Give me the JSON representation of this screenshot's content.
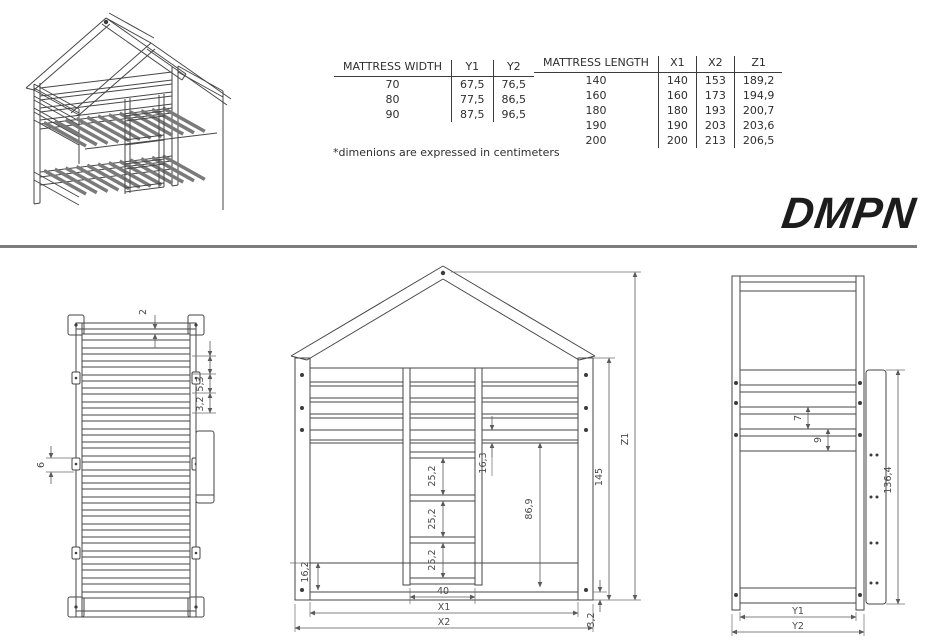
{
  "brand": {
    "logo_text": "DMPN"
  },
  "note": "*dimenions are expressed in centimeters",
  "tables": {
    "width": {
      "headers": [
        "MATTRESS WIDTH",
        "Y1",
        "Y2"
      ],
      "rows": [
        [
          "70",
          "67,5",
          "76,5"
        ],
        [
          "80",
          "77,5",
          "86,5"
        ],
        [
          "90",
          "87,5",
          "96,5"
        ]
      ]
    },
    "length": {
      "headers": [
        "MATTRESS LENGTH",
        "X1",
        "X2",
        "Z1"
      ],
      "rows": [
        [
          "140",
          "140",
          "153",
          "189,2"
        ],
        [
          "160",
          "160",
          "173",
          "194,9"
        ],
        [
          "180",
          "180",
          "193",
          "200,7"
        ],
        [
          "190",
          "190",
          "203",
          "203,6"
        ],
        [
          "200",
          "200",
          "213",
          "206,5"
        ]
      ]
    }
  },
  "views": {
    "top": {
      "dims": {
        "top_gap": "2",
        "slat_pitch": "5,3",
        "slat_width": "3,2",
        "bracket_height": "6"
      }
    },
    "front": {
      "dims": {
        "rail_gap": "16,3",
        "rung_gap_1": "25,2",
        "rung_gap_2": "25,2",
        "rung_gap_3": "25,2",
        "open_height": "86,9",
        "base_height": "16,2",
        "ladder_width": "40",
        "inner_width": "X1",
        "outer_width": "X2",
        "plinth": "3,2",
        "wall_height": "145",
        "total_height": "Z1"
      }
    },
    "side": {
      "dims": {
        "rail_height": "7",
        "rail_gap": "9",
        "ladder_height": "136,4",
        "inner_depth": "Y1",
        "outer_depth": "Y2"
      }
    }
  }
}
